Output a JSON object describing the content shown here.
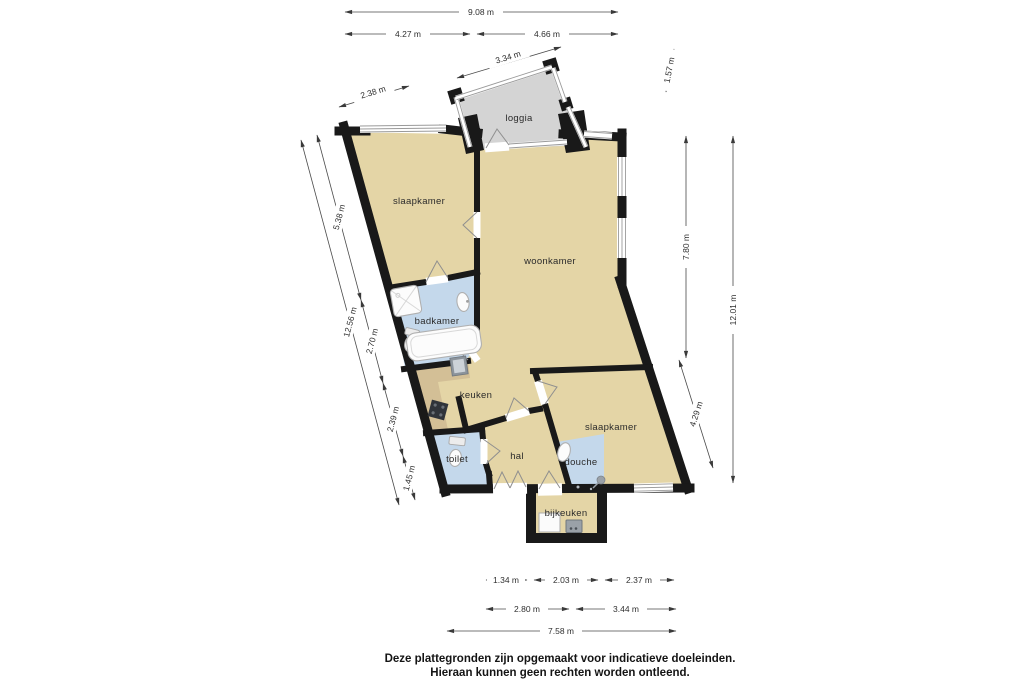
{
  "floorplan": {
    "rooms": [
      {
        "id": "loggia",
        "label": "loggia"
      },
      {
        "id": "bedroom-1",
        "label": "slaapkamer"
      },
      {
        "id": "living",
        "label": "woonkamer"
      },
      {
        "id": "bathroom",
        "label": "badkamer"
      },
      {
        "id": "kitchen",
        "label": "keuken"
      },
      {
        "id": "hall",
        "label": "hal"
      },
      {
        "id": "toilet",
        "label": "toilet"
      },
      {
        "id": "shower",
        "label": "douche"
      },
      {
        "id": "bedroom-2",
        "label": "slaapkamer"
      },
      {
        "id": "utility",
        "label": "bijkeuken"
      }
    ],
    "colors": {
      "floor": "#e4d5a6",
      "wet_floor": "#c4d8eb",
      "loggia_floor": "#d4d4d4",
      "counter": "#d3bf96",
      "wall": "#191919"
    },
    "dimensions": {
      "top_total": "9.08 m",
      "top_left": "4.27 m",
      "top_right": "4.66 m",
      "loggia_width": "3.34 m",
      "upper_left": "2.38 m",
      "loggia_depth": "1.57 m",
      "left_total": "12.56 m",
      "left_1": "5.38 m",
      "left_2": "2.70 m",
      "left_3": "2.39 m",
      "left_4": "1.45 m",
      "right_total": "12.01 m",
      "right_1": "7.80 m",
      "right_2": "4.29 m",
      "bottom_row1_1": "1.34 m",
      "bottom_row1_2": "2.03 m",
      "bottom_row1_3": "2.37 m",
      "bottom_row2_1": "2.80 m",
      "bottom_row2_2": "3.44 m",
      "bottom_total": "7.58 m"
    },
    "disclaimer_line1": "Deze plattegronden zijn opgemaakt voor indicatieve doeleinden.",
    "disclaimer_line2": "Hieraan kunnen geen rechten worden ontleend."
  }
}
